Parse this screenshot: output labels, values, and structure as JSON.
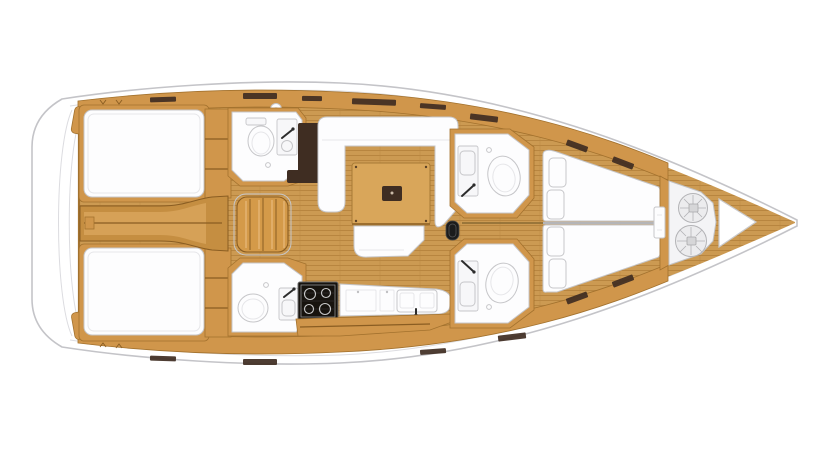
{
  "scene": {
    "description": "Sailing yacht interior layout floor plan, top-down view, bow pointing right",
    "orientation": "bow-right",
    "background": "white"
  },
  "colors": {
    "hull_line": "#c4c4c8",
    "sheer_line": "#dcdce0",
    "wood_band": "#d0964b",
    "wood_band_dark": "#a3722e",
    "wood_mid": "#c58e41",
    "wood_floor": "#cc9a52",
    "wood_floor_stripe": "#b8853f",
    "wood_table": "#d9a65a",
    "table_edge": "#a87b35",
    "wood_steps": "#d49a49",
    "wood_hl": "#ecc088",
    "trim_dark": "#8a5d22",
    "seam_dark": "#8a6a33",
    "furniture_white": "#fdfdfe",
    "furniture_line": "#c6c6c9",
    "soft_line": "#e6e6e9",
    "locker_dark": "#3f2d22",
    "stove_black": "#17130e",
    "rope_fill": "#ececee",
    "rope_line": "#b3b3b6",
    "accent_black": "#1c1c1c"
  },
  "inventory": {
    "aft_double_cabins": 2,
    "forward_cabins": 2,
    "heads_with_toilet_and_sink": 4,
    "companionway_step_treads": 4,
    "galley_stove_burners": 4,
    "galley_sink_basins": 2,
    "salon_settee": "U-shaped white settee",
    "salon_table": "rectangular wood table with dark center insert",
    "salon_bench": 1,
    "forward_berth_pillows": 4,
    "anchor_locker_rope_coils": 2,
    "deck_hatch_circles": 1,
    "swim_platform_arcs": 2
  }
}
